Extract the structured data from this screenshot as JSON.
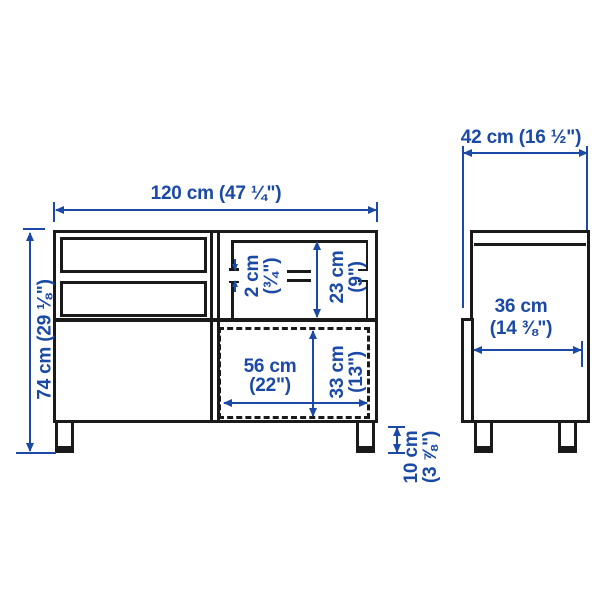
{
  "diagram": {
    "title": "furniture-dimension-drawing",
    "front_view": {
      "width": "120 cm (47 ¼\")",
      "height": "74 cm (29 ⅛\")",
      "shelf_gap": [
        "2 cm",
        "(¾\")"
      ],
      "top_compartment_height": [
        "23 cm",
        "(9\")"
      ],
      "bottom_opening_width": [
        "56 cm",
        "(22\")"
      ],
      "bottom_opening_height": [
        "33 cm",
        "(13\")"
      ],
      "leg_height": [
        "10 cm",
        "(3 ⅞\")"
      ]
    },
    "side_view": {
      "depth": "42 cm (16 ½\")",
      "inner_depth": [
        "36 cm",
        "(14 ⅜\")"
      ]
    },
    "colors": {
      "dimension_blue": "#1b49a6",
      "outline_dark": "#1a1a1a",
      "background": "#ffffff"
    }
  }
}
